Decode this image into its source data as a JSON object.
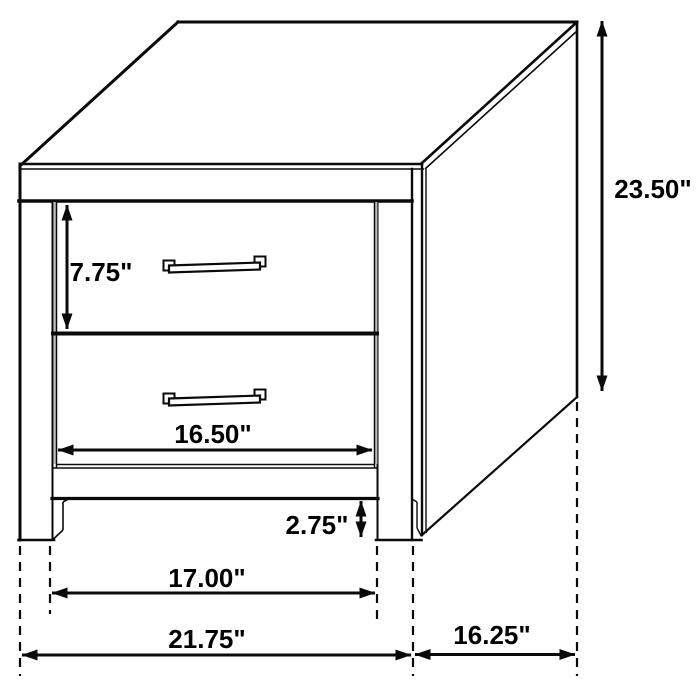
{
  "diagram": {
    "kind": "furniture-dimension-diagram",
    "unit": "inches",
    "labels": {
      "drawer_height": "7.75\"",
      "opening_width": "16.50\"",
      "foot_height": "2.75\"",
      "inner_width": "17.00\"",
      "overall_width": "21.75\"",
      "overall_depth": "16.25\"",
      "overall_height": "23.50\""
    },
    "colors": {
      "line": "#0a0a0a",
      "background": "#ffffff",
      "gap_shade": "#bdbdbd"
    }
  }
}
